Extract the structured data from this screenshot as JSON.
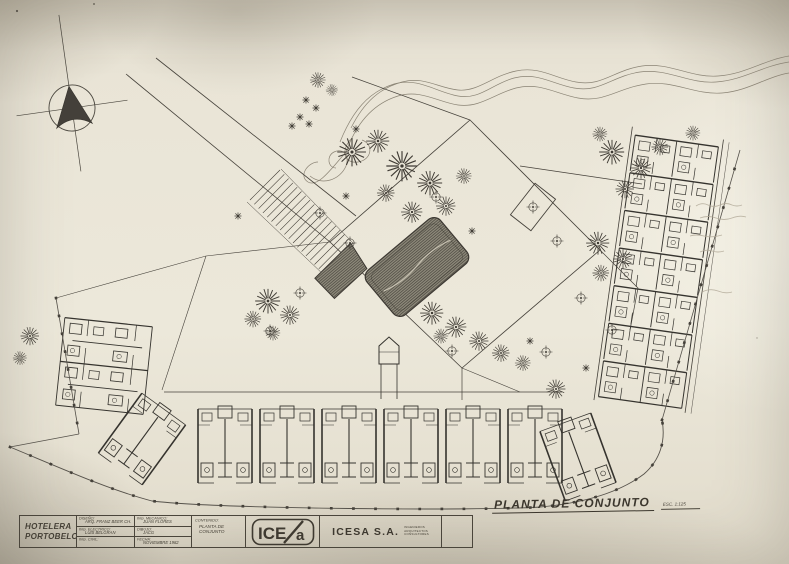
{
  "drawing": {
    "title": "PLANTA DE CONJUNTO",
    "scale": "ESC. 1:125"
  },
  "title_block": {
    "project_line1": "HOTELERA",
    "project_line2": "PORTOBELO",
    "fields": [
      {
        "label": "DISEÑO:",
        "value": "ARQ. FRANZ BEER CH."
      },
      {
        "label": "ING. ELECTRICO:",
        "value": "LUIS BELGRAN"
      },
      {
        "label": "ING. CIVIL:",
        "value": ""
      },
      {
        "label": "ING. MECANICO:",
        "value": "JUAN FLORES"
      },
      {
        "label": "DIBUJO:",
        "value": "JACG"
      },
      {
        "label": "FECHA:",
        "value": "NOVIEMBRE 1982"
      }
    ],
    "contenido_label": "CONTENIDO:",
    "contenido_value": "PLANTA DE CONJUNTO",
    "logo_left": "ICE",
    "logo_right": "a",
    "company": "ICESA S.A.",
    "company_sub1": "INGENIEROS",
    "company_sub2": "ARQUITECTOS",
    "company_sub3": "CONSULTORES"
  },
  "colors": {
    "paper": "#ece8da",
    "ink": "#3c3832",
    "pool_fill": "#8d897a",
    "pencil": "#b3ab9a"
  }
}
